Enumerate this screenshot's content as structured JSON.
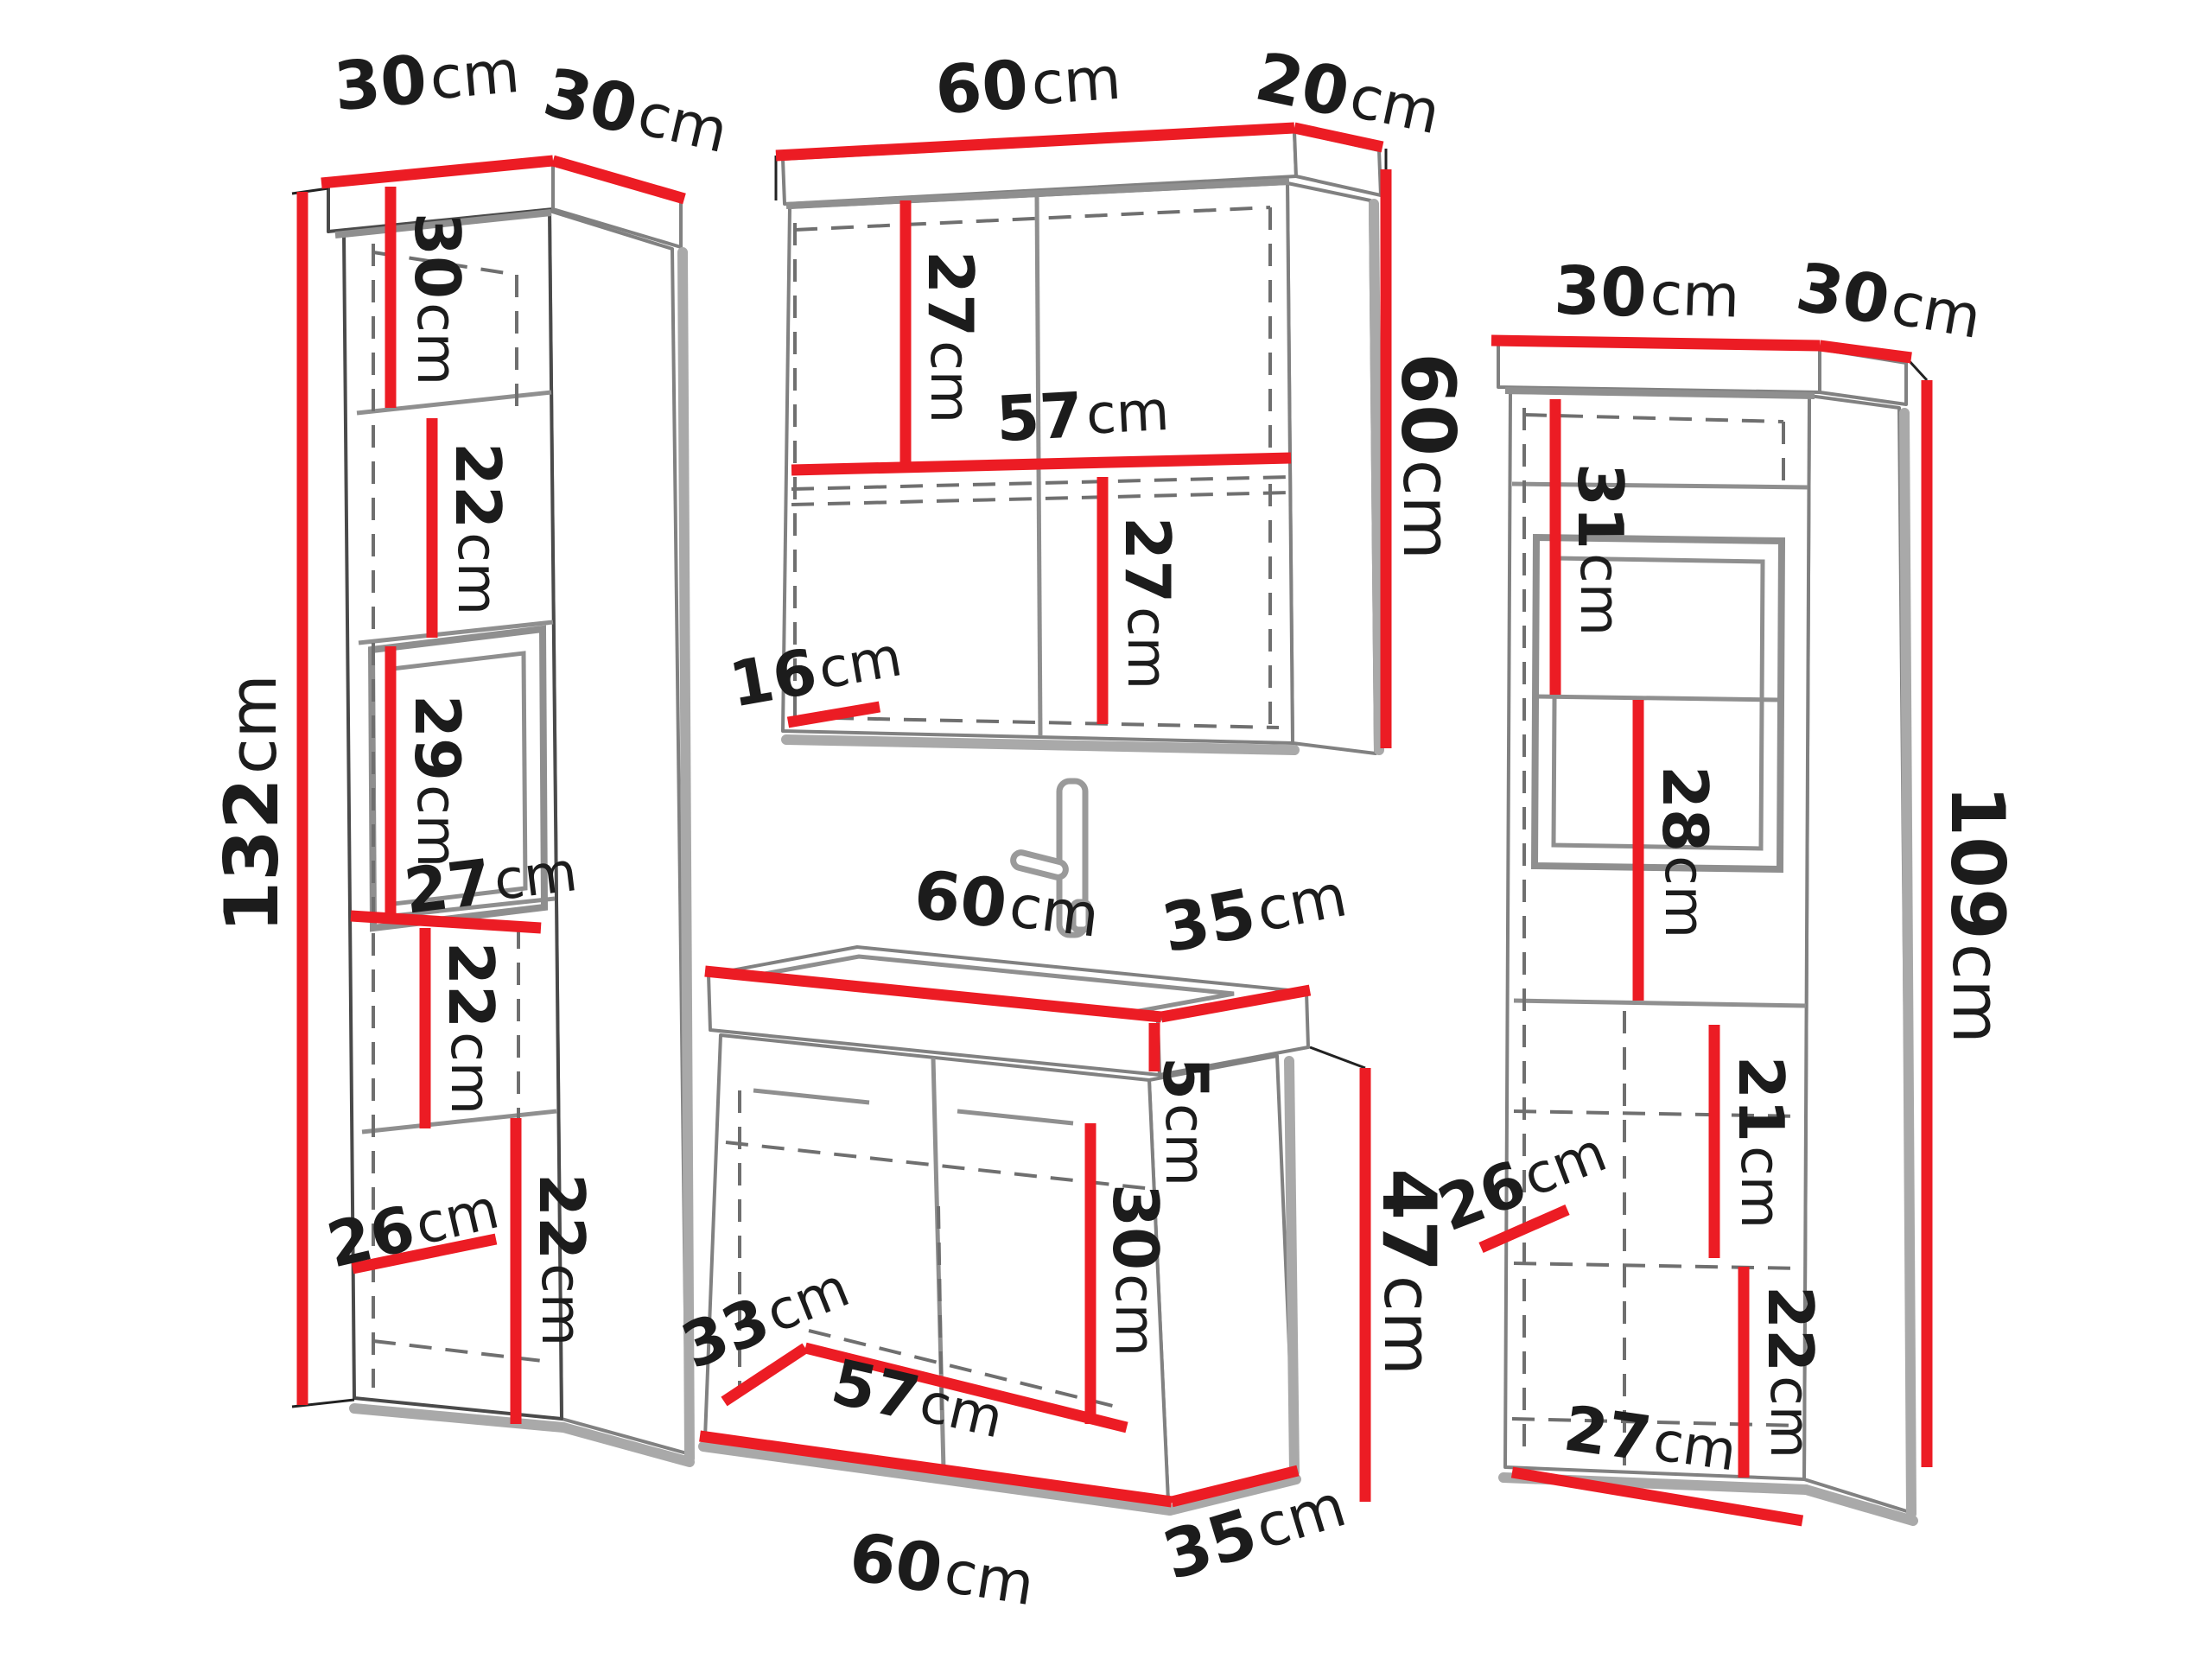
{
  "unit": "cm",
  "colors": {
    "dimension_red": "#ec1c24",
    "label_black": "#1c1c1c",
    "outline_gray": "#8a8a8a",
    "background": "#ffffff"
  },
  "cabinets": [
    {
      "id": "left-tall-cabinet",
      "labels": {
        "top_width": {
          "v": "30",
          "u": "cm"
        },
        "top_depth": {
          "v": "30",
          "u": "cm"
        },
        "height": {
          "v": "132",
          "u": "cm"
        },
        "compartment_1": {
          "v": "30",
          "u": "cm"
        },
        "compartment_2": {
          "v": "22",
          "u": "cm"
        },
        "compartment_3": {
          "v": "29",
          "u": "cm"
        },
        "inner_width": {
          "v": "27",
          "u": "cm"
        },
        "compartment_4": {
          "v": "22",
          "u": "cm"
        },
        "compartment_5": {
          "v": "22",
          "u": "cm"
        },
        "inner_depth": {
          "v": "26",
          "u": "cm"
        }
      }
    },
    {
      "id": "mirror-wall-cabinet",
      "labels": {
        "top_width": {
          "v": "60",
          "u": "cm"
        },
        "top_depth": {
          "v": "20",
          "u": "cm"
        },
        "height": {
          "v": "60",
          "u": "cm"
        },
        "upper_compartment": {
          "v": "27",
          "u": "cm"
        },
        "shelf_width": {
          "v": "57",
          "u": "cm"
        },
        "lower_compartment": {
          "v": "27",
          "u": "cm"
        },
        "bottom_depth": {
          "v": "16",
          "u": "cm"
        }
      }
    },
    {
      "id": "sink-vanity-cabinet",
      "labels": {
        "top_width": {
          "v": "60",
          "u": "cm"
        },
        "top_depth": {
          "v": "35",
          "u": "cm"
        },
        "basin_height": {
          "v": "5",
          "u": "cm"
        },
        "body_height": {
          "v": "47",
          "u": "cm"
        },
        "compartment": {
          "v": "30",
          "u": "cm"
        },
        "inner_depth": {
          "v": "33",
          "u": "cm"
        },
        "inner_width": {
          "v": "57",
          "u": "cm"
        },
        "bottom_width": {
          "v": "60",
          "u": "cm"
        },
        "bottom_depth": {
          "v": "35",
          "u": "cm"
        }
      }
    },
    {
      "id": "right-tall-cabinet",
      "labels": {
        "top_width": {
          "v": "30",
          "u": "cm"
        },
        "top_depth": {
          "v": "30",
          "u": "cm"
        },
        "height": {
          "v": "109",
          "u": "cm"
        },
        "compartment_1": {
          "v": "31",
          "u": "cm"
        },
        "compartment_2": {
          "v": "28",
          "u": "cm"
        },
        "compartment_3": {
          "v": "21",
          "u": "cm"
        },
        "inner_depth": {
          "v": "26",
          "u": "cm"
        },
        "compartment_4": {
          "v": "22",
          "u": "cm"
        },
        "bottom_width": {
          "v": "27",
          "u": "cm"
        }
      }
    }
  ]
}
